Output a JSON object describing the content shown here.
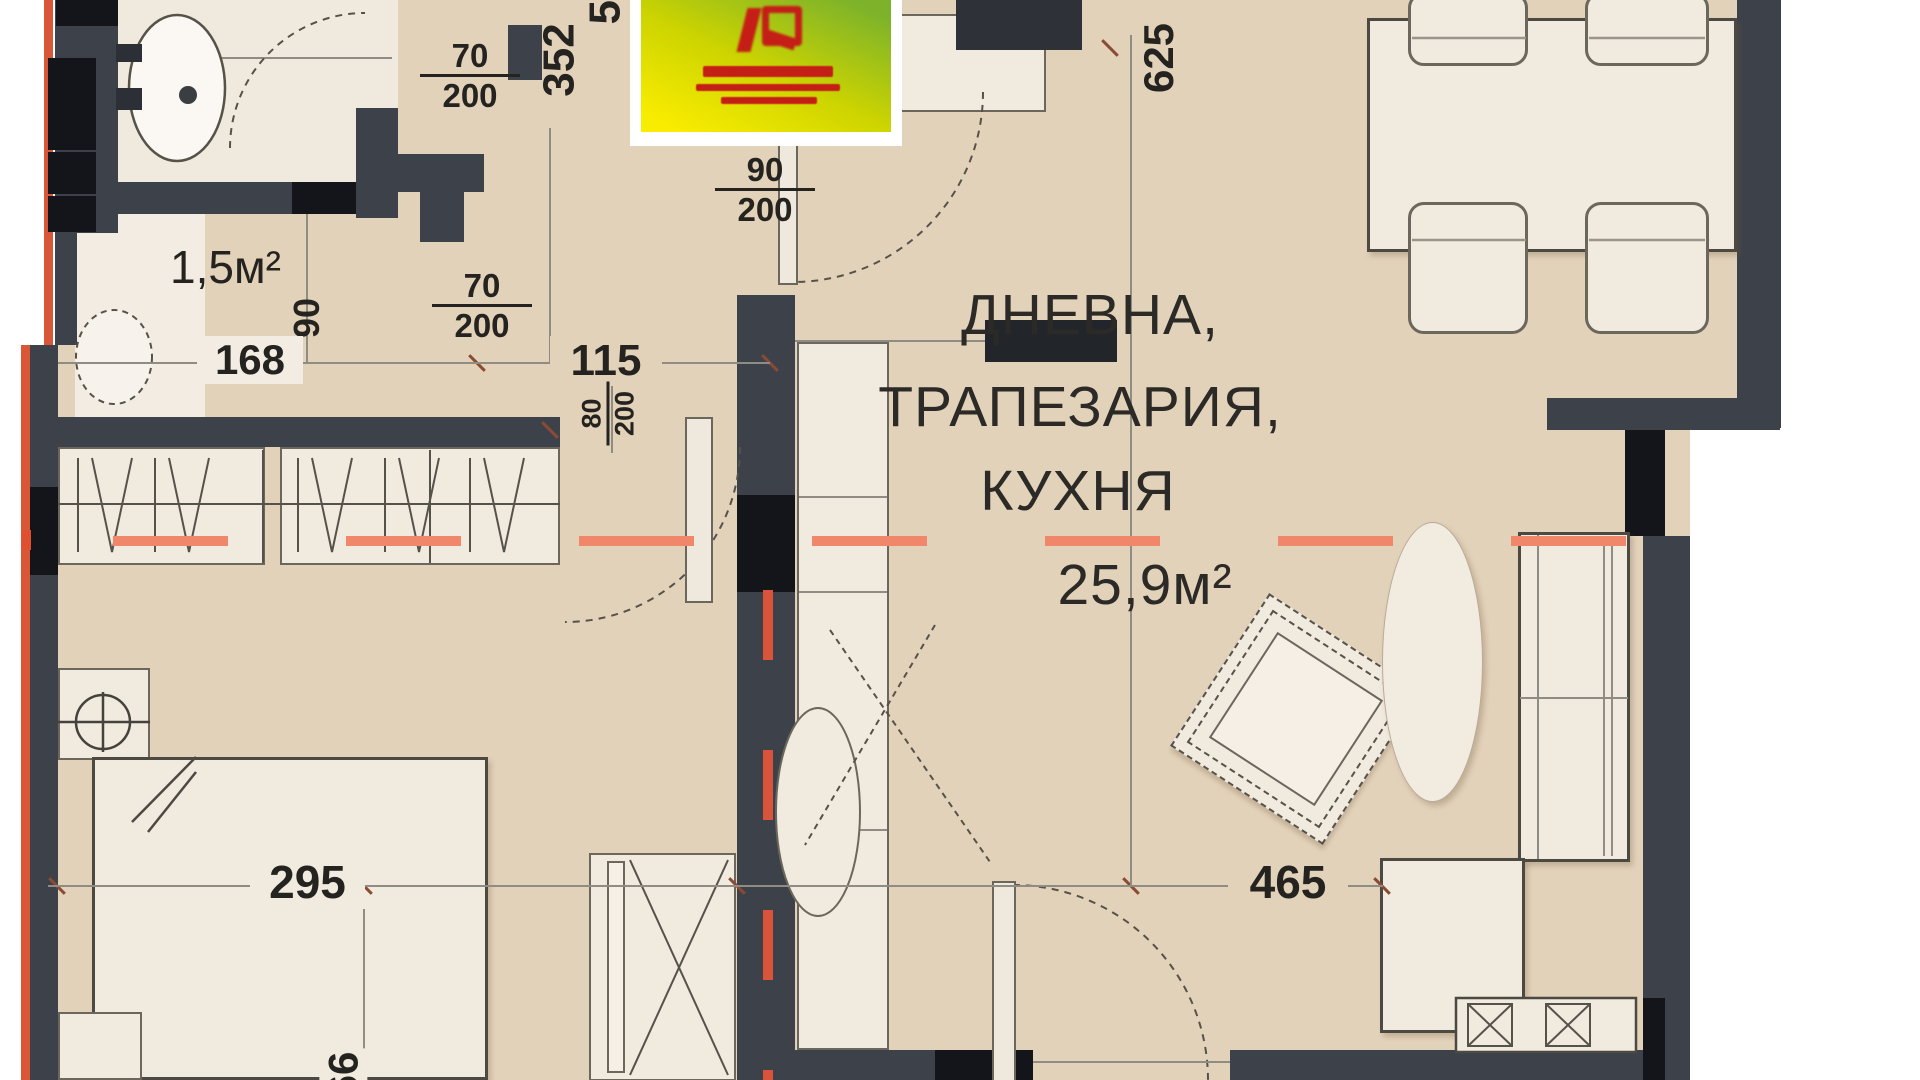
{
  "plan": {
    "rooms": {
      "living": {
        "name_line1": "ДНЕВНА,",
        "name_line2": "ТРАПЕЗАРИЯ,",
        "name_line3": "КУХНЯ",
        "area": "25,9м²"
      },
      "wc": {
        "area": "1,5м²"
      }
    },
    "dimensions": {
      "bath_door_num": "70",
      "bath_door_den": "200",
      "wc_door_num": "70",
      "wc_door_den": "200",
      "entry_door_num": "90",
      "entry_door_den": "200",
      "hall_length": "352",
      "hall_length_clipped": "53",
      "wc_width": "168",
      "door_90": "90",
      "opening_width": "115",
      "opening_leaf_num": "80",
      "opening_leaf_den": "200",
      "living_length": "625",
      "bedroom_width": "295",
      "living_width": "465",
      "bed_length_clipped": "66"
    },
    "colors": {
      "floor": "#e3d2ba",
      "floor_light": "#f0e9dd",
      "wall": "#3d424a",
      "wall_black": "#13151a",
      "accent_red": "#d95636",
      "axis_salmon": "#f0876a",
      "axis_red": "#d9543a",
      "logo_green": "#7db32a",
      "logo_yellow": "#f8ec00",
      "logo_red": "#c41e17"
    }
  }
}
